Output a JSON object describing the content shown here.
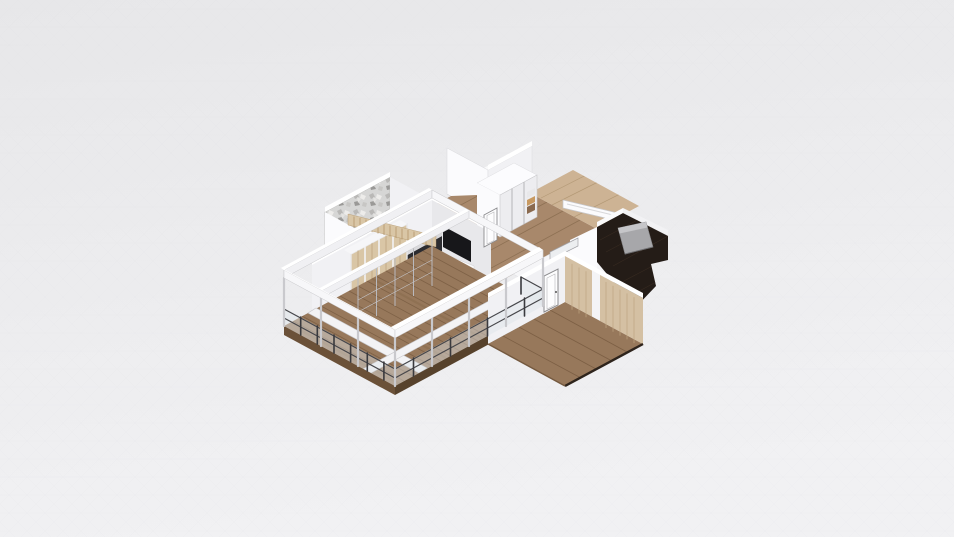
{
  "app": {
    "name": "3d-floorplan-viewer",
    "view": "perspective-overhead-render",
    "visible_text": ""
  },
  "canvas": {
    "width": 954,
    "height": 537,
    "bgTop": "#e8e8ea",
    "bgBottom": "#f1f1f3",
    "mesh": "#dcdce1"
  },
  "colors": {
    "woodMain": "#97785b",
    "woodMid": "#a8886b",
    "woodPale": "#cdb394",
    "plankLine": "#75593f",
    "darkFloor": "#241c17",
    "darkPlank": "#3b2d22",
    "fascia": "#6b5138",
    "fascia2": "#57422c",
    "wallBright": "#fbfbfd",
    "wallLight": "#f1f1f4",
    "wallShade": "#e8e8eb",
    "wallZone": "#f6f6f8",
    "wallTop": "#ffffff",
    "beamFace": "#f7f7f9",
    "beamFace2": "#f0f0f3",
    "floorFrame": "#f3f3f5",
    "postGray": "#c9c9cd",
    "railDark": "#46464a",
    "glass": "#dde4e8",
    "slatWood": "#d9c6a6",
    "slatLine": "#b29469",
    "panelWood": "#d4c0a3",
    "panelLine": "#bfa481",
    "closetFace": "#ededf0",
    "closetLine": "#b5b5b8",
    "counterDark": "#2c2c30",
    "tvBlack": "#17171a",
    "bedGray": "#a7a7aa",
    "bedLight": "#c6c6c9",
    "doorWhite": "#fdfdfe",
    "doorFrame": "#8b8b8e",
    "shelfBrown": "#8a6a4f",
    "shelfTan": "#c89a62",
    "texBase": "#d6d6d5"
  },
  "scene": {
    "projection": "perspective",
    "rooms": [
      {
        "id": "living-room",
        "floor": "wood"
      },
      {
        "id": "terrace-deck",
        "floor": "wood",
        "features": [
          "glass-railing",
          "pergola-beams",
          "white-floor-frame"
        ]
      },
      {
        "id": "stair-room",
        "floor": "wood",
        "features": [
          "textured-accent-wall",
          "wood-slat-stairs"
        ]
      },
      {
        "id": "bedroom-top",
        "floor": "dark-wood",
        "features": [
          "white-door",
          "shelves"
        ]
      },
      {
        "id": "hallway",
        "floor": "wood",
        "features": [
          "sliding-door-closet",
          "white-door"
        ]
      },
      {
        "id": "bedroom-right",
        "floor": "dark-wood",
        "features": [
          "gray-bed",
          "window-frames"
        ]
      },
      {
        "id": "room-bottom-right",
        "floor": "wood",
        "features": [
          "white-door",
          "wood-panel-wall"
        ]
      }
    ],
    "furniture": [
      "sliding-wardrobe",
      "tv",
      "kitchen-counter",
      "closet",
      "bed",
      "white-sideboard"
    ]
  }
}
